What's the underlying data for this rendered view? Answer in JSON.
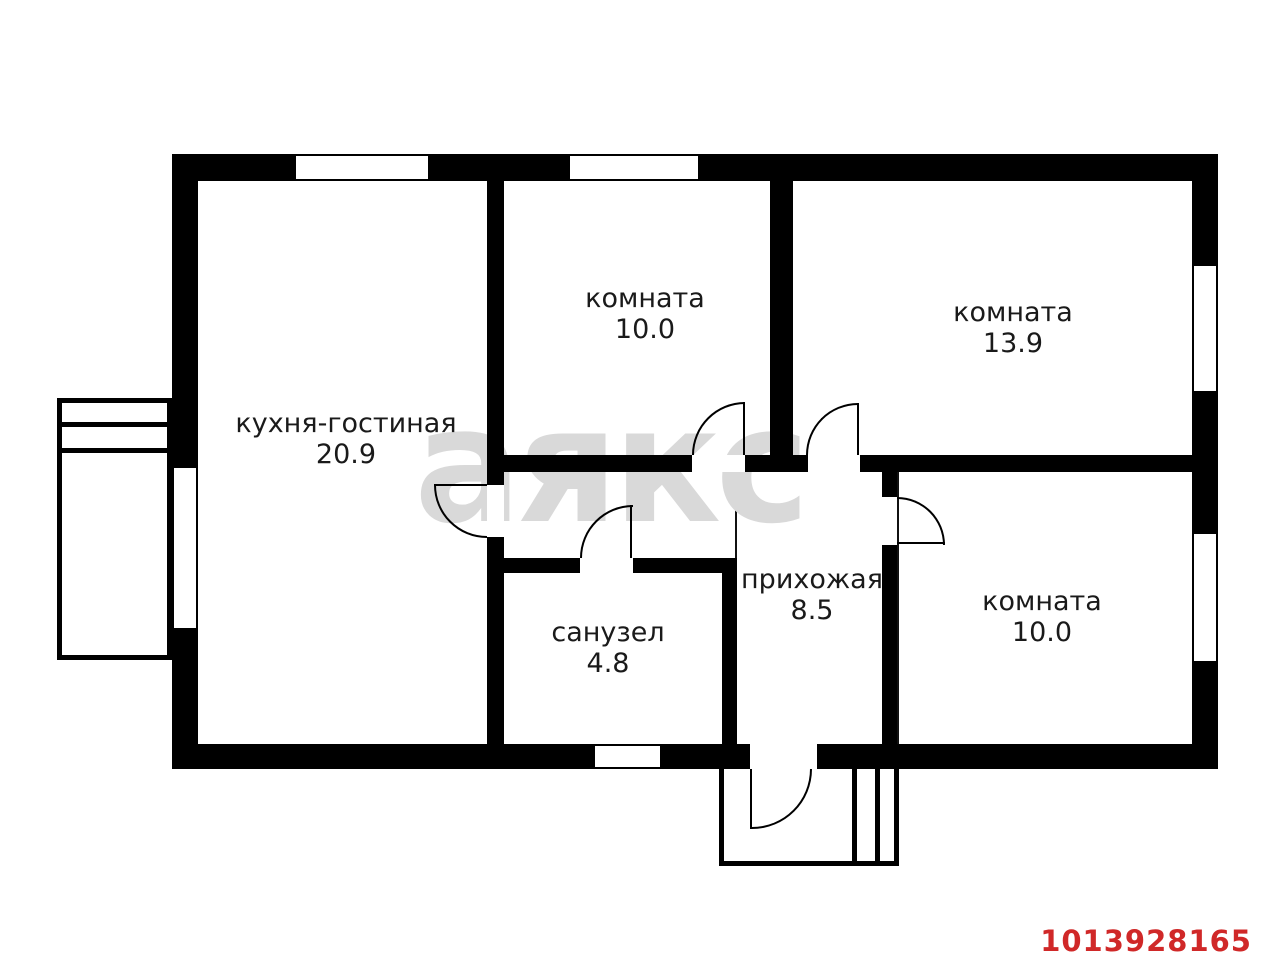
{
  "plan": {
    "rooms": [
      {
        "name": "кухня-гостиная",
        "area": "20.9"
      },
      {
        "name": "комната",
        "area": "10.0"
      },
      {
        "name": "комната",
        "area": "13.9"
      },
      {
        "name": "прихожая",
        "area": "8.5"
      },
      {
        "name": "санузел",
        "area": "4.8"
      },
      {
        "name": "комната",
        "area": "10.0"
      }
    ],
    "watermark": "аякс",
    "listing_id": "1013928165",
    "colors": {
      "walls": "#000000",
      "background": "#ffffff",
      "watermark": "#d9d9d9",
      "listing_id": "#d02828"
    }
  }
}
